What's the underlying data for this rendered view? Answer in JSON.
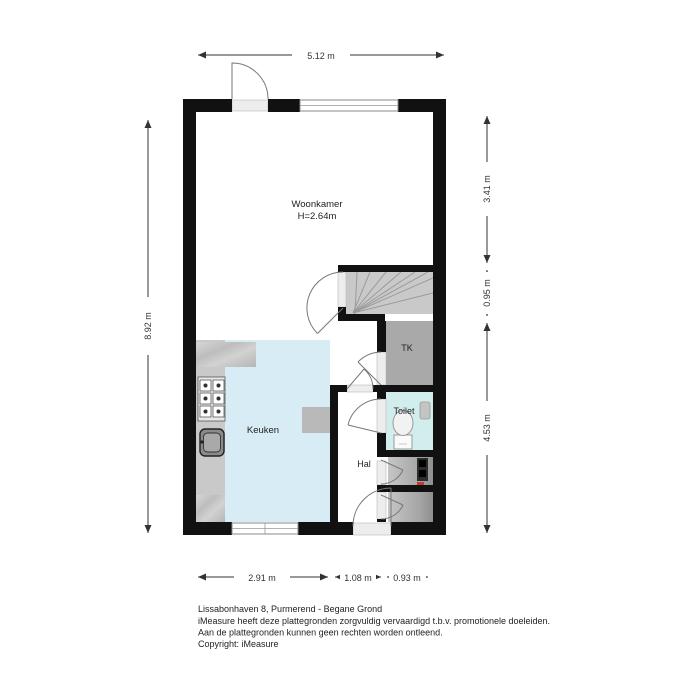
{
  "plan": {
    "rooms": {
      "woonkamer": {
        "label": "Woonkamer",
        "height": "H=2.64m"
      },
      "keuken": {
        "label": "Keuken"
      },
      "hal": {
        "label": "Hal"
      },
      "toilet": {
        "label": "Toilet"
      },
      "tk": {
        "label": "TK"
      }
    },
    "dimensions": {
      "top": "5.12 m",
      "left": "8.92 m",
      "right": [
        "3.41 m",
        "0.95 m",
        "4.53 m"
      ],
      "bottom": [
        "2.91 m",
        "1.08 m",
        "0.93 m"
      ]
    }
  },
  "footer": {
    "title": "Lissabonhaven 8, Purmerend - Begane Grond",
    "disclaimer1": "iMeasure heeft deze plattegronden zorgvuldig vervaardigd t.b.v. promotionele doeleiden.",
    "disclaimer2": "Aan de plattegronden kunnen geen rechten worden ontleend.",
    "copyright": "Copyright: iMeasure"
  },
  "colors": {
    "wall": "#111111",
    "kitchen_floor": "#d7ecf4",
    "toilet_floor": "#d2eeec",
    "stairs_floor": "#c9c9c9",
    "tk_floor": "#a9a9a9",
    "closet_floor_light": "#c2c2c2",
    "closet_floor_dark": "#8f8f8f",
    "counter": "#c9c9c9",
    "appliance_red": "#c0392b",
    "dimension_text": "#333333"
  }
}
